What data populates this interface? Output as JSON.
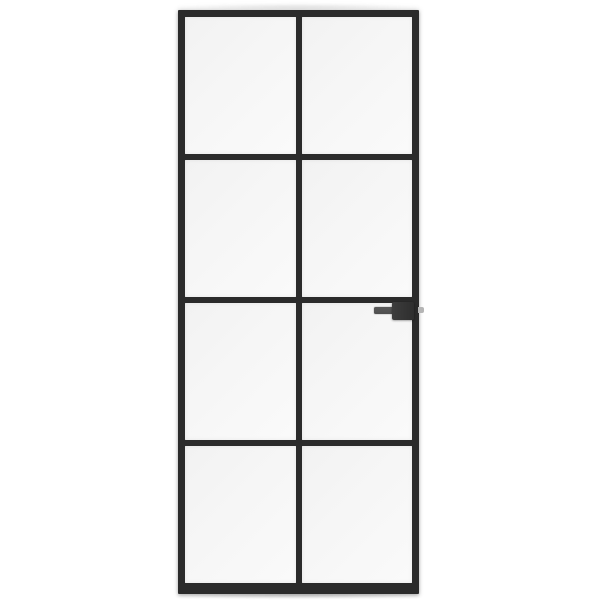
{
  "scene": {
    "description": "Product photograph of a black steel-framed interior glass door with eight frosted glass panes arranged in two columns and four rows, a dark lever handle with lock body mounted on the right stile just below the second horizontal mullion, and a small latch bolt protruding from the right edge, shown on a plain white background",
    "background_color": "#ffffff"
  },
  "door": {
    "columns": 2,
    "rows": 4,
    "pane_count": 8,
    "frame_style": "slim black metal frame with thicker bottom rail",
    "glass_style": "frosted translucent white glass",
    "handle_side": "right",
    "handle_parts": [
      "lever-bar",
      "lock-body",
      "latch-bolt"
    ]
  },
  "colors": {
    "bg": "#ffffff",
    "frame": "#2b2b2b",
    "glass": "#f6f6f6",
    "glass-hi": "#fafafa",
    "lever": "#4f4f4f",
    "lock": "#343434",
    "latch": "#b5b5b5"
  }
}
